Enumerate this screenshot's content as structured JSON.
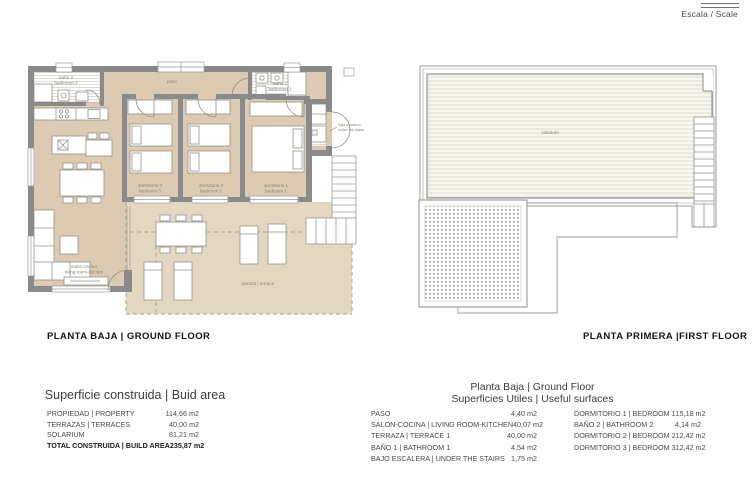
{
  "scale": {
    "label": "Escala / Scale"
  },
  "colors": {
    "floor": "#dccab2",
    "terrace": "#e4d7c2",
    "wall": "#8a8a8a"
  },
  "ground_floor": {
    "title": "PLANTA BAJA | GROUND FLOOR",
    "labels": {
      "bath2_es": "baño 2",
      "bath2_en": "bathroom 2",
      "paso": "paso",
      "bath1_es": "baño 1",
      "bath1_en": "bathroom 1",
      "bed3_es": "dormitorio 3",
      "bed3_en": "bedroom 3",
      "bed2_es": "dormitorio 2",
      "bed2_en": "bedroom 2",
      "bed1_es": "dormitorio 1",
      "bed1_en": "bedroom 1",
      "living_es": "salon-cocina",
      "living_en": "living room-kitchen",
      "terrace": "terraza | terrace",
      "under_stairs_es": "bajo escalera",
      "under_stairs_en": "under the stairs"
    }
  },
  "first_floor": {
    "title": "PLANTA PRIMERA |FIRST FLOOR",
    "labels": {
      "solarium": "solarium"
    }
  },
  "build_area_table": {
    "title": "Superficie construida | Buid area",
    "rows": [
      {
        "label": "PROPIEDAD | PROPERTY",
        "value": "114,66 m2"
      },
      {
        "label": "TERRAZAS | TERRACES",
        "value": "40,00 m2"
      },
      {
        "label": "SOLARIUM",
        "value": "81,21 m2"
      },
      {
        "label": "TOTAL CONSTRUIDA | BUILD AREA",
        "value": "235,87 m2"
      }
    ]
  },
  "useful_surfaces_table": {
    "title_line1": "Planta Baja | Ground Floor",
    "title_line2": "Superficies Utiles | Useful surfaces",
    "left_rows": [
      {
        "label": "PASO",
        "value": "4,40 m2"
      },
      {
        "label": "SALON-COCINA | LIVING ROOM-KITCHEN",
        "value": "40,07 m2"
      },
      {
        "label": "TERRAZA | TERRACE 1",
        "value": "40,00 m2"
      },
      {
        "label": "BAÑO 1 | BATHROOM 1",
        "value": "4,54 m2"
      },
      {
        "label": "BAJO ESCALERA | UNDER THE STAIRS",
        "value": "1,75 m2"
      }
    ],
    "right_rows": [
      {
        "label": "DORMITORIO 1 | BEDROOM 1",
        "value": "15,18 m2"
      },
      {
        "label": "BAÑO 2 | BATHROOM 2",
        "value": "4,14 m2"
      },
      {
        "label": "DORMITORIO 2 | BEDROOM 2",
        "value": "12,42 m2"
      },
      {
        "label": "DORMITORIO 3 | BEDROOM 3",
        "value": "12,42 m2"
      }
    ]
  }
}
